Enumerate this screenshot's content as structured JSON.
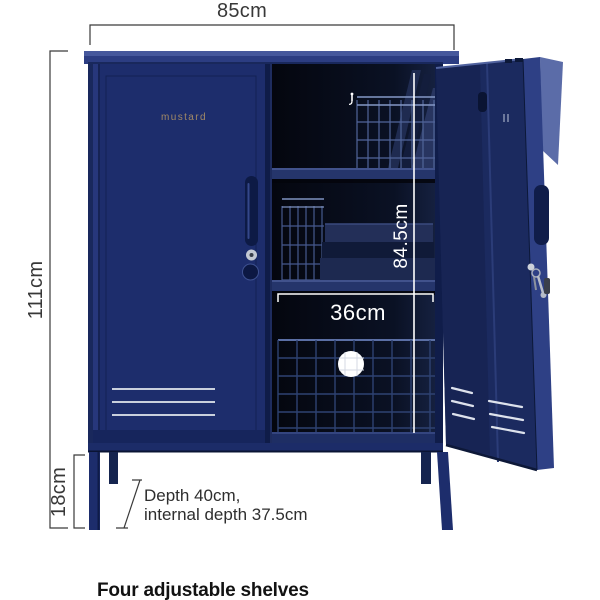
{
  "page": {
    "background": "#ffffff"
  },
  "dimensions": {
    "width_label": "85cm",
    "height_label": "111cm",
    "leg_height_label": "18cm",
    "internal_height_label": "84.5cm",
    "internal_width_label": "36cm",
    "depth_note_line1": "Depth 40cm,",
    "depth_note_line2": "internal depth 37.5cm"
  },
  "product": {
    "brand": "mustard",
    "caption": "Four adjustable shelves"
  },
  "icons": {
    "hook": "hook-icon",
    "keys": "keys-icon",
    "lock": "lock-icon"
  },
  "colors": {
    "body_navy": "#1d2d6c",
    "frame_dark": "#101d4a",
    "lid_blue": "#33448c",
    "side_periwinkle": "#5b6ca8",
    "interior_dark": "#05070f",
    "wire_blue": "#46598e",
    "dimension_line": "#3a3a3a",
    "white_marks": "#ffffff",
    "text_dark": "#2e2e2e",
    "brand_gold": "#b09365"
  }
}
